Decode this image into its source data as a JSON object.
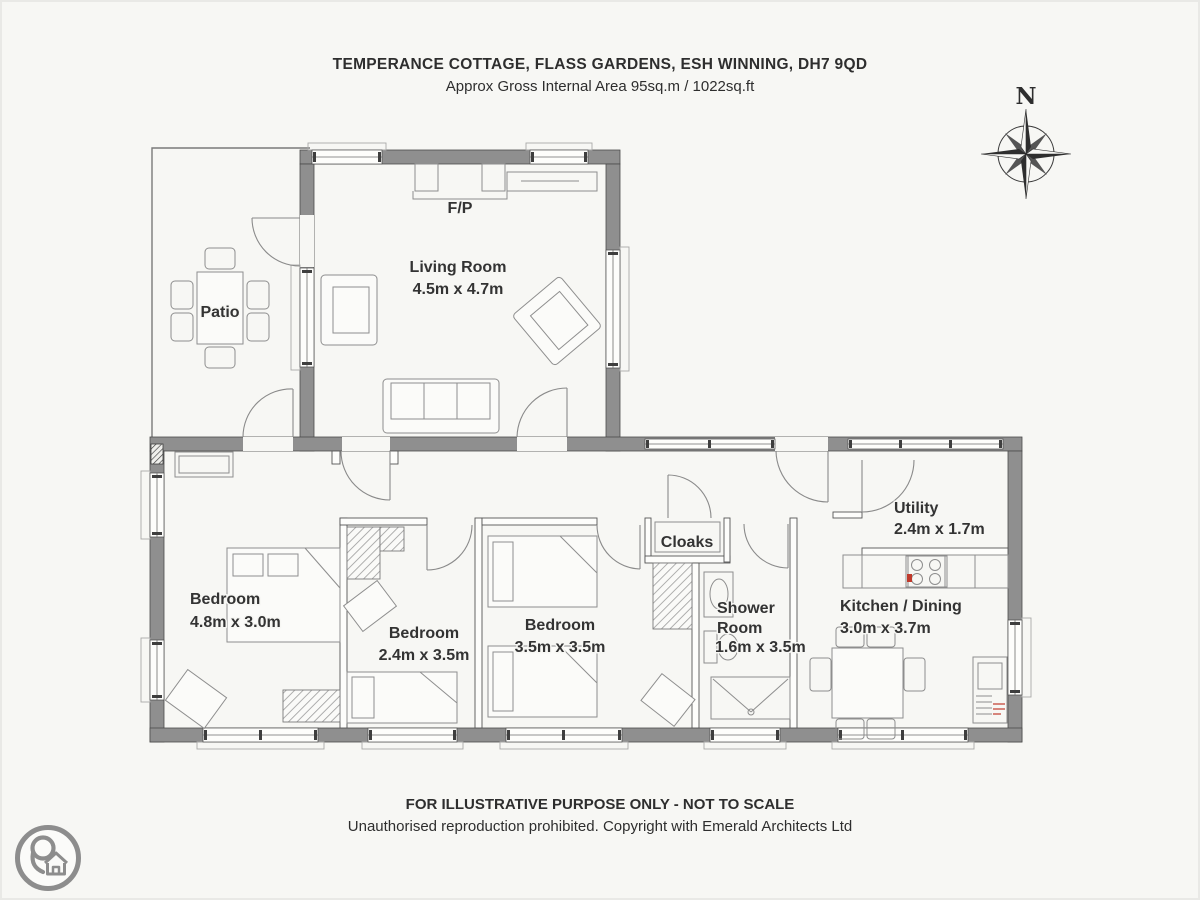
{
  "header": {
    "title": "TEMPERANCE COTTAGE, FLASS GARDENS, ESH WINNING, DH7 9QD",
    "subtitle": "Approx Gross Internal Area 95sq.m / 1022sq.ft"
  },
  "compass": {
    "north_label": "N"
  },
  "plan": {
    "patio": {
      "label": "Patio"
    },
    "living_room": {
      "label": "Living Room",
      "dims": "4.5m x 4.7m"
    },
    "fireplace": {
      "label": "F/P"
    },
    "bedroom_1": {
      "label": "Bedroom",
      "dims": "4.8m x 3.0m"
    },
    "bedroom_2": {
      "label": "Bedroom",
      "dims": "2.4m x 3.5m"
    },
    "bedroom_3": {
      "label": "Bedroom",
      "dims": "3.5m x 3.5m"
    },
    "cloaks": {
      "label": "Cloaks"
    },
    "shower_room": {
      "label_line1": "Shower",
      "label_line2": "Room",
      "dims": "1.6m x 3.5m"
    },
    "kitchen_dining": {
      "label": "Kitchen / Dining",
      "dims": "3.0m x 3.7m"
    },
    "utility": {
      "label": "Utility",
      "dims": "2.4m x 1.7m"
    }
  },
  "footer": {
    "line1": "FOR ILLUSTRATIVE PURPOSE ONLY - NOT TO SCALE",
    "line2": "Unauthorised reproduction prohibited. Copyright with Emerald Architects Ltd"
  },
  "colors": {
    "wall": "#8f8f8f",
    "wall_outline": "#4a4a4a",
    "furniture_line": "#8e8e8e",
    "text": "#2e2e2e",
    "accent_red": "#c0392b",
    "logo_gray": "#8d8d8d",
    "background": "#f7f7f4"
  }
}
